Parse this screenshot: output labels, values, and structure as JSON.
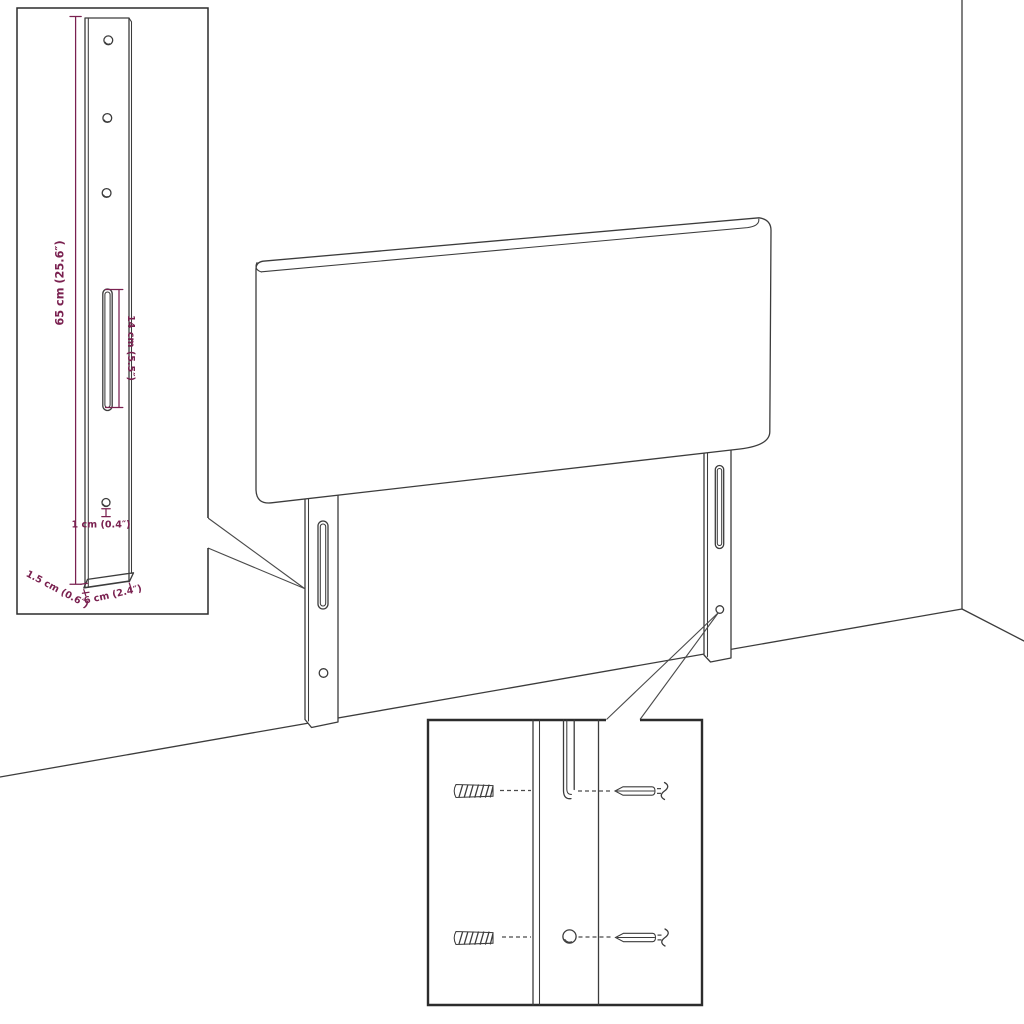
{
  "diagram": {
    "subject": "Headboard with two mounting legs - assembly dimension diagram",
    "colors": {
      "line": "#3c3c3c",
      "dimension": "#7a2150",
      "inset_border": "#2c2c2c",
      "background": "#ffffff"
    },
    "bracket_inset": {
      "height_label": "65 cm (25.6″)",
      "slot_label": "14 cm (5.5″)",
      "hole_label": "1 cm (0.4″)",
      "thickness_label": "1.5 cm (0.6″)",
      "width_label": "6 cm (2.4″)"
    }
  }
}
